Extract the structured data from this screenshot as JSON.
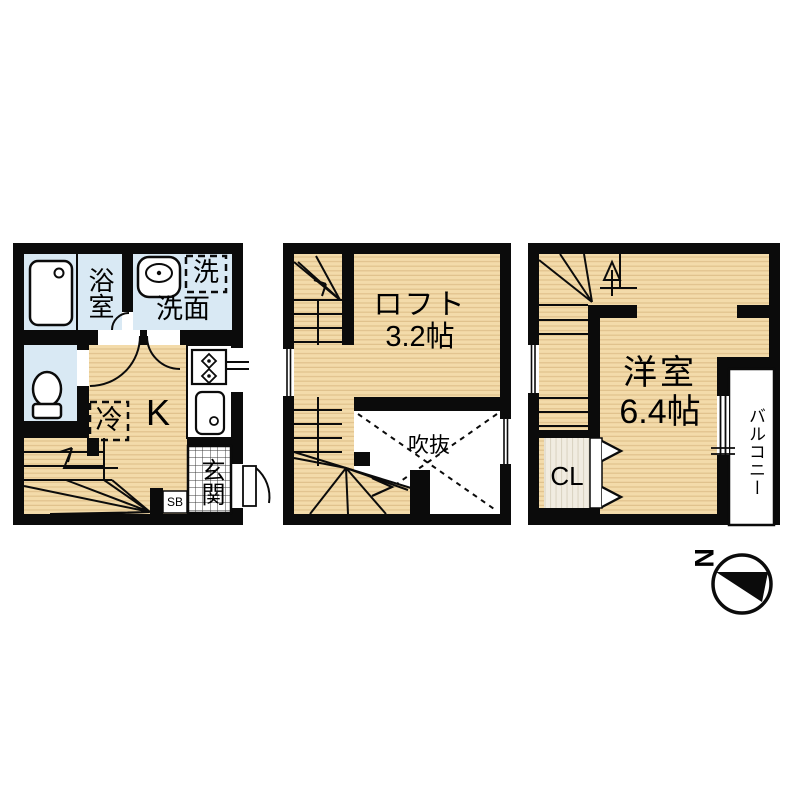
{
  "plan1": {
    "bath": "浴室",
    "washroom": "洗面",
    "washer": "洗",
    "kitchen": "K",
    "fridge": "冷",
    "entrance": "玄関",
    "shoe_box": "SB"
  },
  "plan2": {
    "loft_name": "ロフト",
    "loft_size": "3.2帖",
    "void": "吹抜"
  },
  "plan3": {
    "room_name": "洋室",
    "room_size": "6.4帖",
    "closet": "CL",
    "balcony": "バルコニー"
  },
  "compass": {
    "north": "N"
  },
  "colors": {
    "wall": "#0b0b0b",
    "floor": "#f3dbaa",
    "floor_stripe": "#e0c28c",
    "water_room": "#d9e9f4",
    "closet_floor": "#f1ece1",
    "tile_line": "#3c3c3c",
    "background": "#ffffff"
  }
}
